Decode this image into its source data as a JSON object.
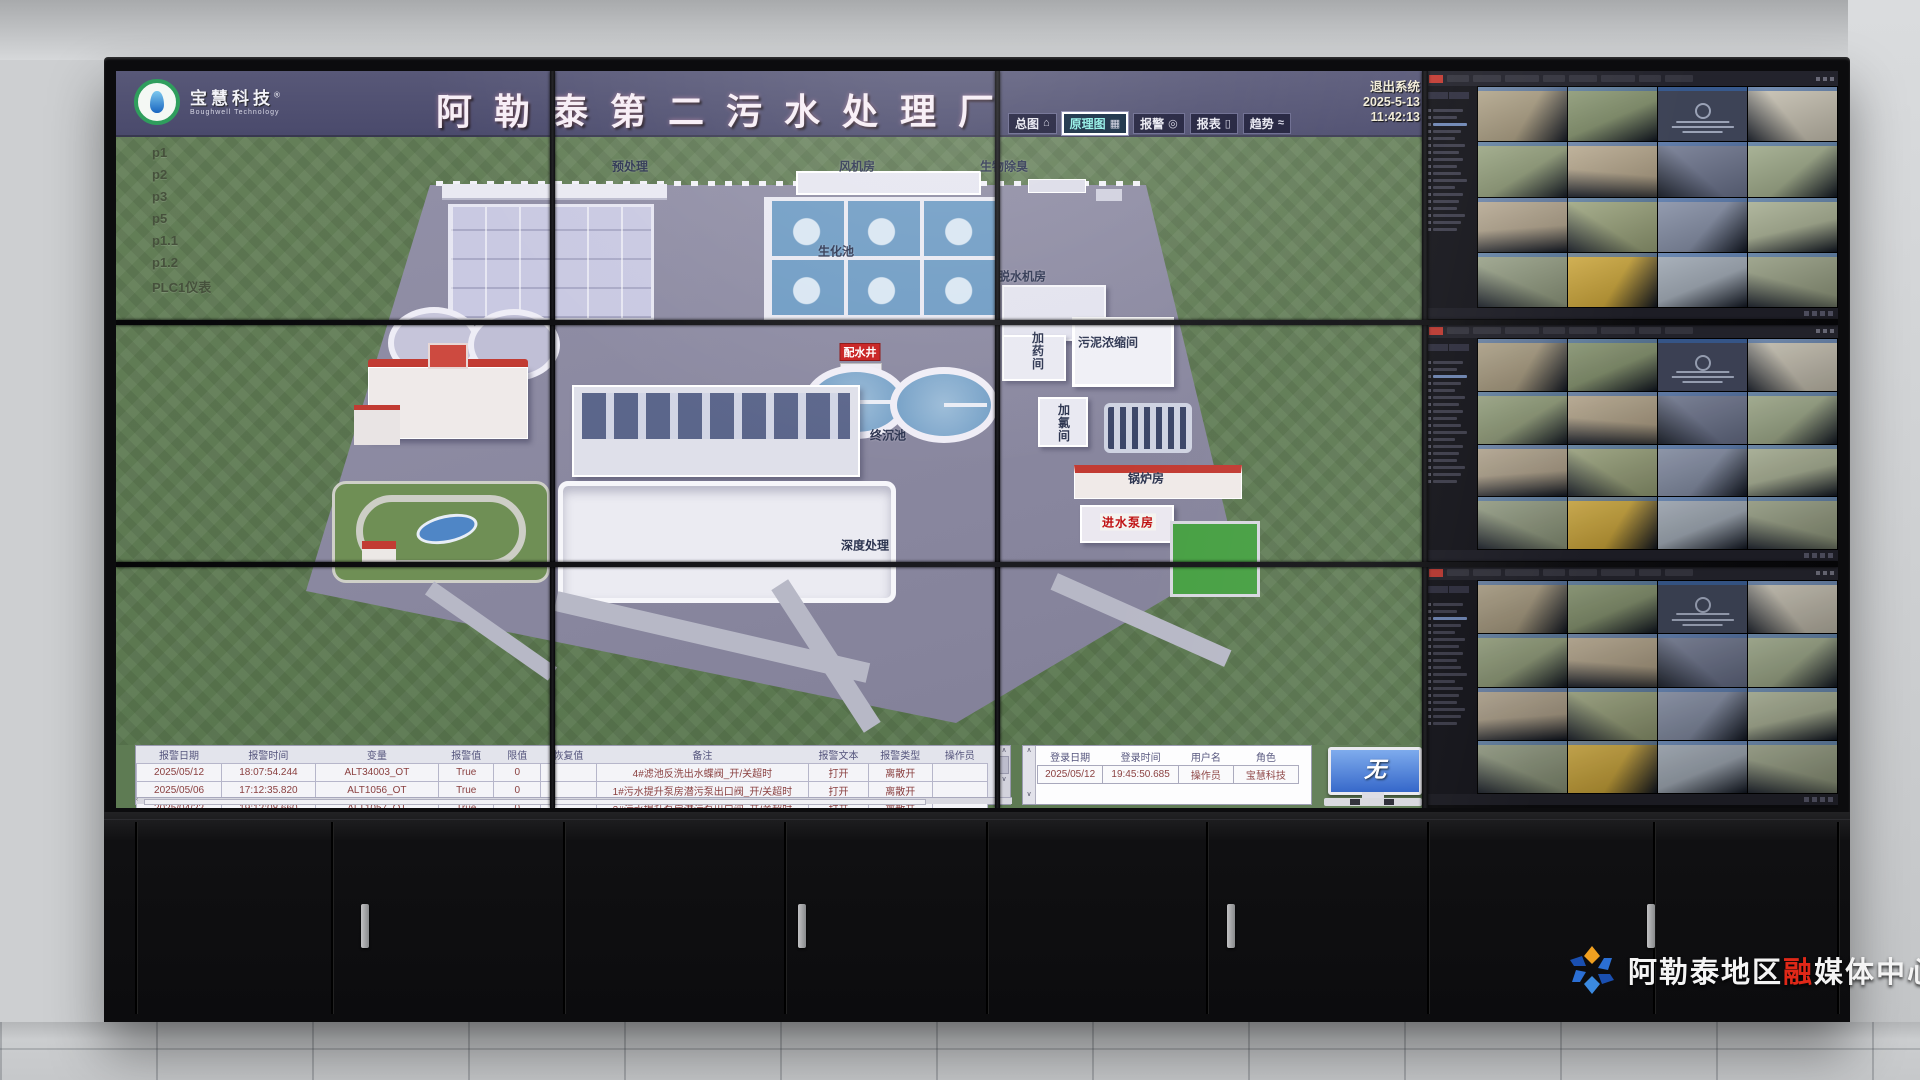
{
  "scada": {
    "logo": {
      "company": "宝慧科技",
      "registered": "®",
      "subtitle": "Boughwell Technology"
    },
    "title": "阿勒泰第二污水处理厂",
    "nav": [
      {
        "label": "总图",
        "icon": "home-icon",
        "selected": false
      },
      {
        "label": "原理图",
        "icon": "diagram-grid-icon",
        "selected": true
      },
      {
        "label": "报警",
        "icon": "alarm-bell-icon",
        "selected": false
      },
      {
        "label": "报表",
        "icon": "report-doc-icon",
        "selected": false
      },
      {
        "label": "趋势",
        "icon": "trend-curve-icon",
        "selected": false
      }
    ],
    "system": {
      "exit": "退出系统",
      "date": "2025-5-13",
      "time": "11:42:13"
    },
    "sidebar": [
      "p1",
      "p2",
      "p3",
      "p5",
      "p1.1",
      "p1.2",
      "PLC1仪表"
    ],
    "plant_labels": [
      "预处理",
      "风机房",
      "生物除臭",
      "生化池",
      "脱水机房",
      "加药间",
      "污泥浓缩间",
      "加氯间",
      "配水井",
      "终沉池",
      "锅炉房",
      "进水泵房",
      "深度处理"
    ],
    "alarm_table": {
      "headers": [
        "报警日期",
        "报警时间",
        "变量",
        "报警值",
        "限值",
        "恢复值",
        "备注",
        "报警文本",
        "报警类型",
        "操作员"
      ],
      "rows": [
        [
          "2025/05/12",
          "18:07:54.244",
          "ALT34003_OT",
          "True",
          "0",
          "",
          "4#滤池反洗出水蝶阀_开/关超时",
          "打开",
          "离散开",
          ""
        ],
        [
          "2025/05/06",
          "17:12:35.820",
          "ALT1056_OT",
          "True",
          "0",
          "",
          "1#污水提升泵房潜污泵出口阀_开/关超时",
          "打开",
          "离散开",
          ""
        ],
        [
          "2025/04/22",
          "19:12:08.660",
          "ALT1057_OT",
          "True",
          "0",
          "",
          "2#污水提升泵房潜污泵出口阀_开/关超时",
          "打开",
          "离散开",
          ""
        ]
      ]
    },
    "login_table": {
      "headers": [
        "登录日期",
        "登录时间",
        "用户名",
        "角色"
      ],
      "rows": [
        [
          "2025/05/12",
          "19:45:50.685",
          "操作员",
          "宝慧科技"
        ]
      ]
    },
    "monitor_widget": {
      "screen_text": "无"
    }
  },
  "cctv": {
    "monitors": 3,
    "grid_cols": 4,
    "grid_rows": 4,
    "offline_tile_index": 2,
    "offline_color": "#3d4356",
    "palette": [
      "#a89a7c",
      "#7f8e66",
      "#3d4356",
      "#c4beae",
      "#8e9b74",
      "#b2a286",
      "#68708a",
      "#98a482",
      "#ae9f86",
      "#959e75",
      "#7e88a0",
      "#a2aa8c",
      "#8c967a",
      "#c8a02e",
      "#98a2ae",
      "#8e967a"
    ]
  },
  "watermark": {
    "prefix": "阿勒泰地区",
    "accent": "融",
    "suffix": "媒体中心",
    "accent_color": "#e02818"
  },
  "colors": {
    "header_purple": "#50506f",
    "field_green": "#5e7b53",
    "pavement": "#8e8ca3",
    "water_blue": "#6f9cc4",
    "roof_red": "#c23b33",
    "alarm_text": "#8a4040",
    "nav_selected_text": "#8ef0e6"
  }
}
